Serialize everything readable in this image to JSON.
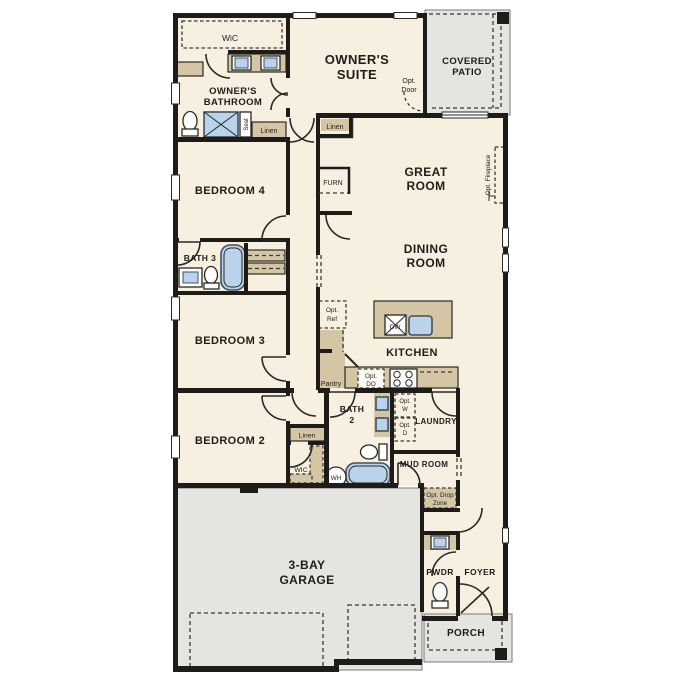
{
  "colors": {
    "floor": "#f7f0e0",
    "wall": "#1e1c19",
    "cabinet": "#d4c6a5",
    "outdoor": "#e5e4e1",
    "fixture": "#b9d3ea",
    "line": "#2a2926",
    "bg": "#ffffff"
  },
  "labels": {
    "owners_wic": "WiC",
    "owners_bathroom": [
      "OWNER'S",
      "BATHROOM"
    ],
    "owners_suite": [
      "OWNER'S",
      "SUITE"
    ],
    "opt_door": [
      "Opt.",
      "Door"
    ],
    "covered_patio": [
      "COVERED",
      "PATIO"
    ],
    "seat": "Seat",
    "linen_bath": "Linen",
    "linen_hall": "Linen",
    "furnace": "FURN",
    "great_room": [
      "GREAT",
      "ROOM"
    ],
    "opt_fireplace": "Opt. Fireplace",
    "dining_room": [
      "DINING",
      "ROOM"
    ],
    "bedroom4": "BEDROOM 4",
    "bath3": "BATH 3",
    "bedroom3": "BEDROOM 3",
    "bedroom2": "BEDROOM 2",
    "opt_ref": [
      "Opt.",
      "Ref"
    ],
    "dishwasher": "DW",
    "kitchen": "KITCHEN",
    "pantry": "Pantry",
    "opt_double_oven": [
      "Opt.",
      "DO"
    ],
    "linen_bed2": "Linen",
    "wic_bed2": "WIC",
    "bath2": [
      "BATH",
      "2"
    ],
    "opt_washer": [
      "Opt.",
      "W"
    ],
    "opt_dryer": [
      "Opt.",
      "D"
    ],
    "laundry": "LAUNDRY",
    "mud_room": "MUD ROOM",
    "water_heater": "WH",
    "opt_drop_zone": [
      "Opt. Drop",
      "Zone"
    ],
    "powder": "PWDR",
    "foyer": "FOYER",
    "garage": [
      "3-BAY",
      "GARAGE"
    ],
    "porch": "PORCH"
  }
}
